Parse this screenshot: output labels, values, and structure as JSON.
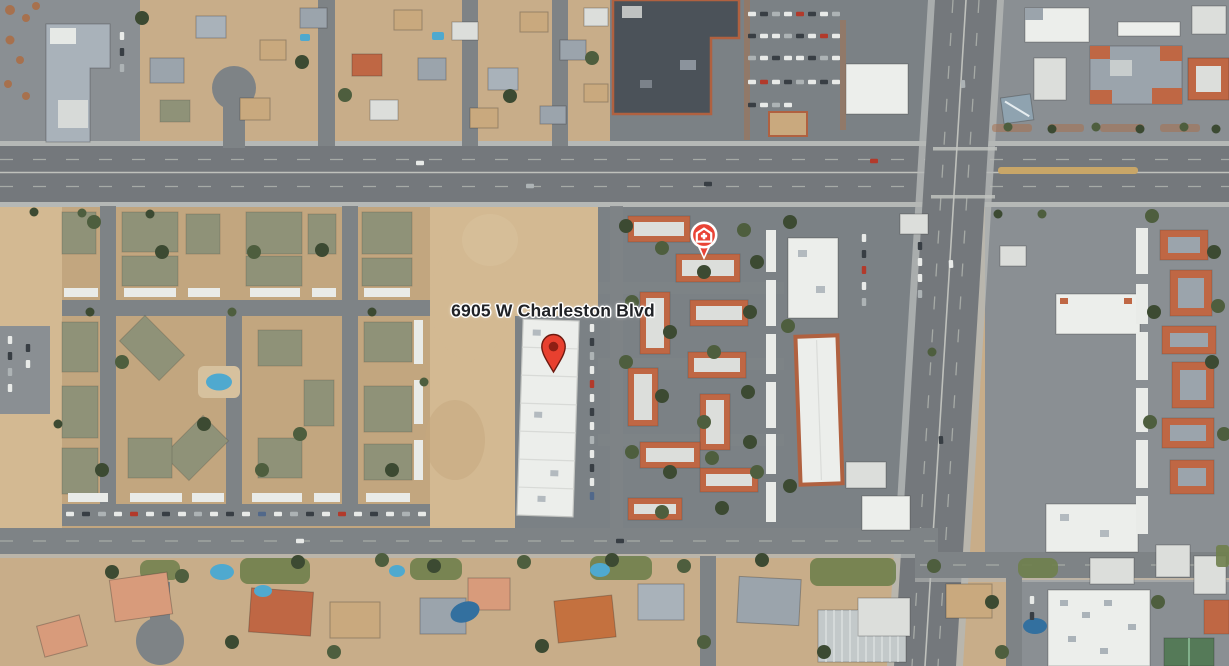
{
  "map": {
    "view_type": "satellite-imagery",
    "address_label": "6905 W Charleston Blvd",
    "markers": [
      {
        "name": "medical-poi-pin",
        "type": "urgent-care-poi",
        "glyph": "hospital-cross",
        "x_px": 704,
        "y_px": 261
      },
      {
        "name": "destination-pin",
        "type": "red-teardrop-pin",
        "glyph": "pin",
        "x_px": 553,
        "y_px": 374
      }
    ],
    "palette": {
      "base_tan": "#c8ad89",
      "base_tanD": "#c2a67f",
      "desert": "#d3b992",
      "lot": "#7b8185",
      "lotL": "#8a8f93",
      "road": "#7e8386",
      "roadM": "#74787c",
      "sw": "#b5b8b6",
      "lane": "#a6aaa6",
      "centerline": "#bfc1bc",
      "median_tan": "#c8a668",
      "roof_white": "#eceeeb",
      "roof_offwhite": "#dcdedb",
      "roof_gray": "#9ba4ac",
      "roof_bluegray": "#a9b2ba",
      "roof_dark": "#5d646b",
      "roof_charcoal": "#4b5259",
      "tile_red": "#bf6744",
      "trim_red": "#b06140",
      "olive_roof": "#8f9278",
      "carport": "#e9ebe8",
      "lawn": "#6f7f4c",
      "pool": "#4fa9cf",
      "poolD": "#33709f",
      "planter": "#a7714e",
      "tree_dark": "#3c4a32",
      "tree_mid": "#4e5e3e",
      "tree_light": "#607148",
      "house_tan": "#c9a97e",
      "salmon": "#d89b7b",
      "car_white": "#e8eae8",
      "car_dark": "#383e44",
      "car_red": "#b23a2b",
      "car_blue": "#51688a",
      "car_silver": "#adb3b5",
      "label_ink": "#202226",
      "pin_red": "#e8402f",
      "pin_dark": "#8e1f14",
      "pin_stroke": "#6e1a10",
      "poi_red": "#e94436"
    }
  }
}
